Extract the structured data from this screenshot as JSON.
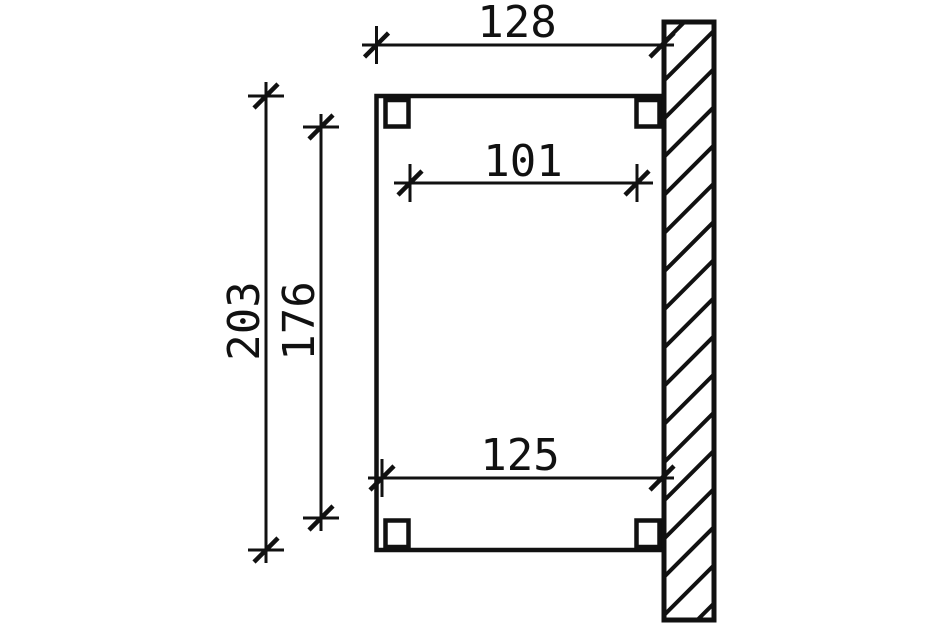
{
  "drawing": {
    "dimensions": {
      "overall_width": "128",
      "inner_width": "101",
      "overall_height": "203",
      "inner_height": "176",
      "lower_width": "125"
    },
    "colors": {
      "line": "#111111",
      "background": "#ffffff"
    }
  }
}
